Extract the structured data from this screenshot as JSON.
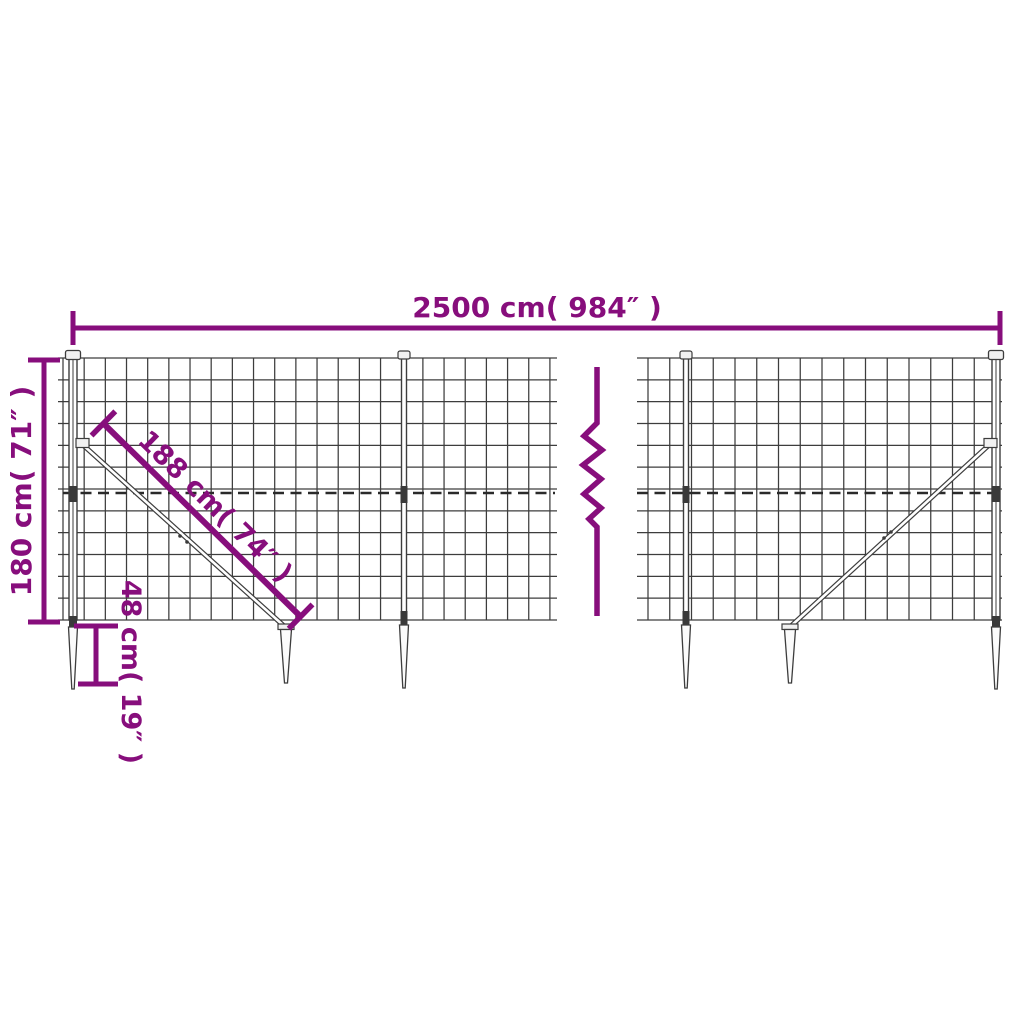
{
  "colors": {
    "dimension_accent": "#870e7c",
    "fence_line": "#3d3d3d",
    "background": "#ffffff"
  },
  "dimensions": {
    "width": {
      "label": "2500 cm( 984″ )",
      "value_cm": 2500,
      "value_inch": 984
    },
    "height": {
      "label": "180 cm( 71″ )",
      "value_cm": 180,
      "value_inch": 71
    },
    "diagonal_brace": {
      "label": "188 cm( 74″ )",
      "value_cm": 188,
      "value_inch": 74
    },
    "ground_spike": {
      "label": "48 cm( 19″ )",
      "value_cm": 48,
      "value_inch": 19
    }
  },
  "fence": {
    "sections_visible": 2,
    "posts_visible": 4,
    "ground_spikes_visible": 6,
    "diagonal_braces_visible": 2,
    "break_mark": "zigzag"
  }
}
